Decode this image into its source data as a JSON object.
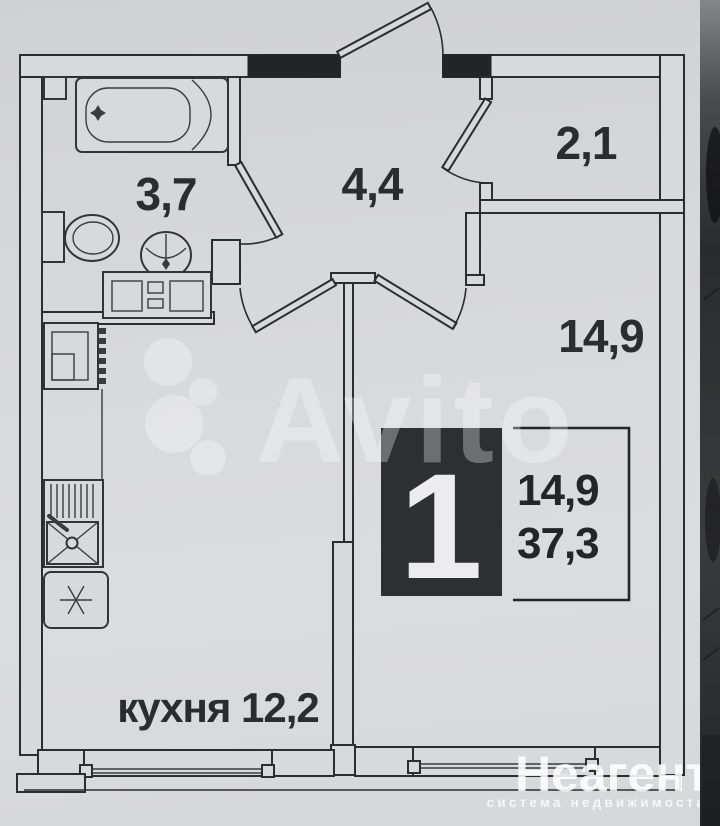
{
  "plan": {
    "rooms": [
      {
        "id": "bathroom",
        "area_label": "3,7"
      },
      {
        "id": "hallway",
        "area_label": "4,4"
      },
      {
        "id": "wardrobe",
        "area_label": "2,1"
      },
      {
        "id": "living_room",
        "area_label": "14,9"
      },
      {
        "id": "kitchen",
        "area_label": "кухня 12,2"
      }
    ],
    "badge": {
      "rooms_count": "1",
      "living_area": "14,9",
      "total_area": "37,3"
    },
    "watermarks": {
      "marketplace": "Avito",
      "agency_name": "Неагент",
      "agency_tagline": "система недвижимости"
    },
    "colors": {
      "paper": "#d7d8da",
      "line": "#2c2d2f",
      "badge_bg": "#2e2f31",
      "watermark": "#ffffff"
    }
  }
}
